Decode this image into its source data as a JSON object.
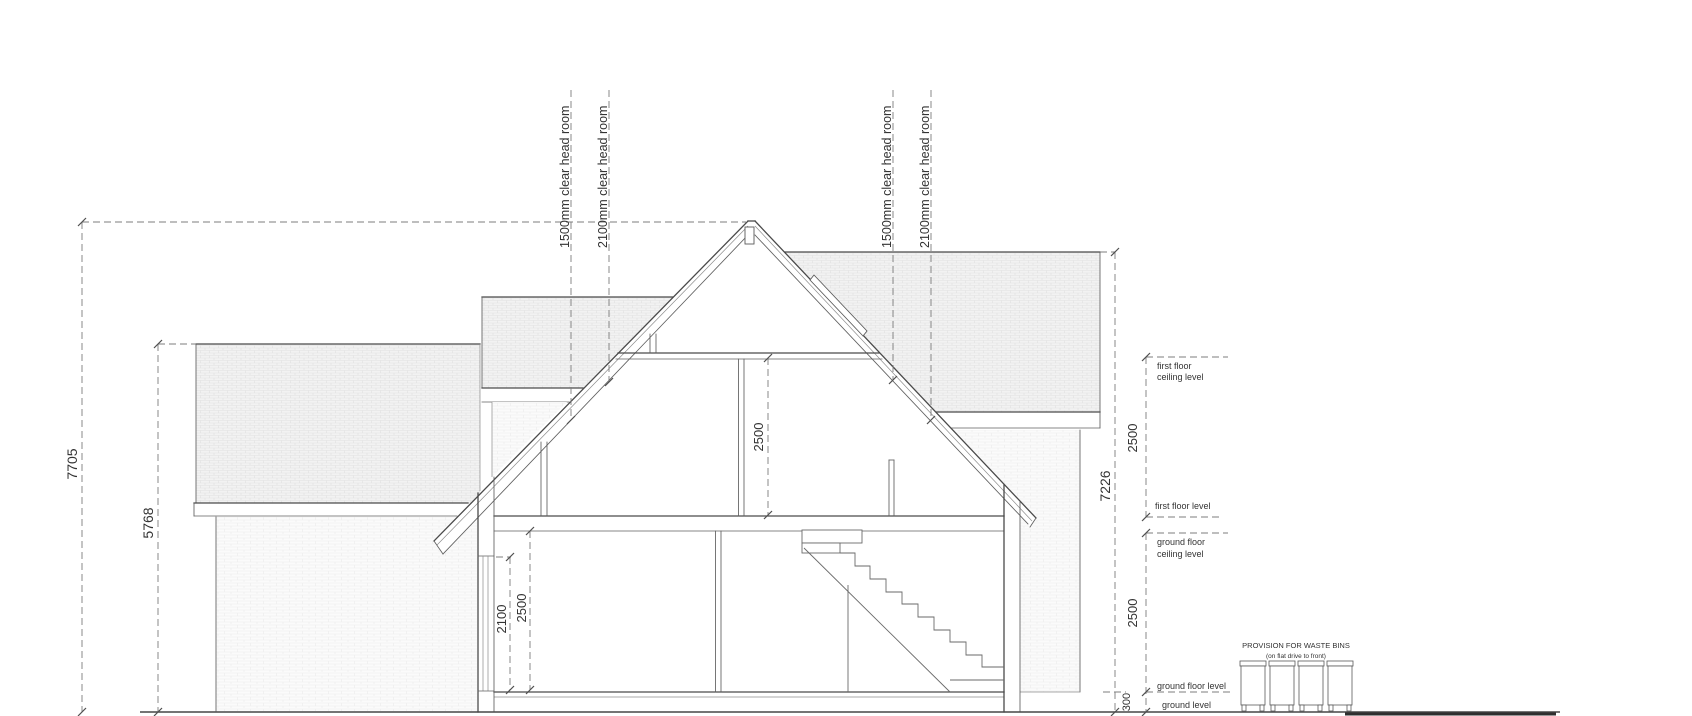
{
  "drawing": {
    "headroom_labels": [
      "1500mm clear head room",
      "2100mm clear head room",
      "1500mm clear head room",
      "2100mm clear head room"
    ],
    "dimensions": {
      "ridge_height": "7705",
      "annex_eaves_height": "5768",
      "rear_ridge_height": "7226",
      "first_floor_room_height": "2500",
      "window_head_height": "2100",
      "ground_floor_room_height": "2500",
      "first_floor_storey": "2500",
      "ground_floor_storey": "2500",
      "ground_offset": "300"
    },
    "levels": {
      "ff_ceiling_1": "first floor",
      "ff_ceiling_2": "ceiling level",
      "ff": "first floor level",
      "gf_ceiling_1": "ground floor",
      "gf_ceiling_2": "ceiling level",
      "gf": "ground floor level",
      "ground": "ground level"
    },
    "bins": {
      "title": "PROVISION FOR WASTE BINS",
      "subtitle": "(on flat drive to front)"
    },
    "colors": {
      "line": "#4a4a4a",
      "dim_line": "#7c7c7c",
      "text": "#333333",
      "roof_hatch": "#e0e0e0",
      "wall_hatch": "#ebebeb",
      "background": "#ffffff"
    }
  }
}
